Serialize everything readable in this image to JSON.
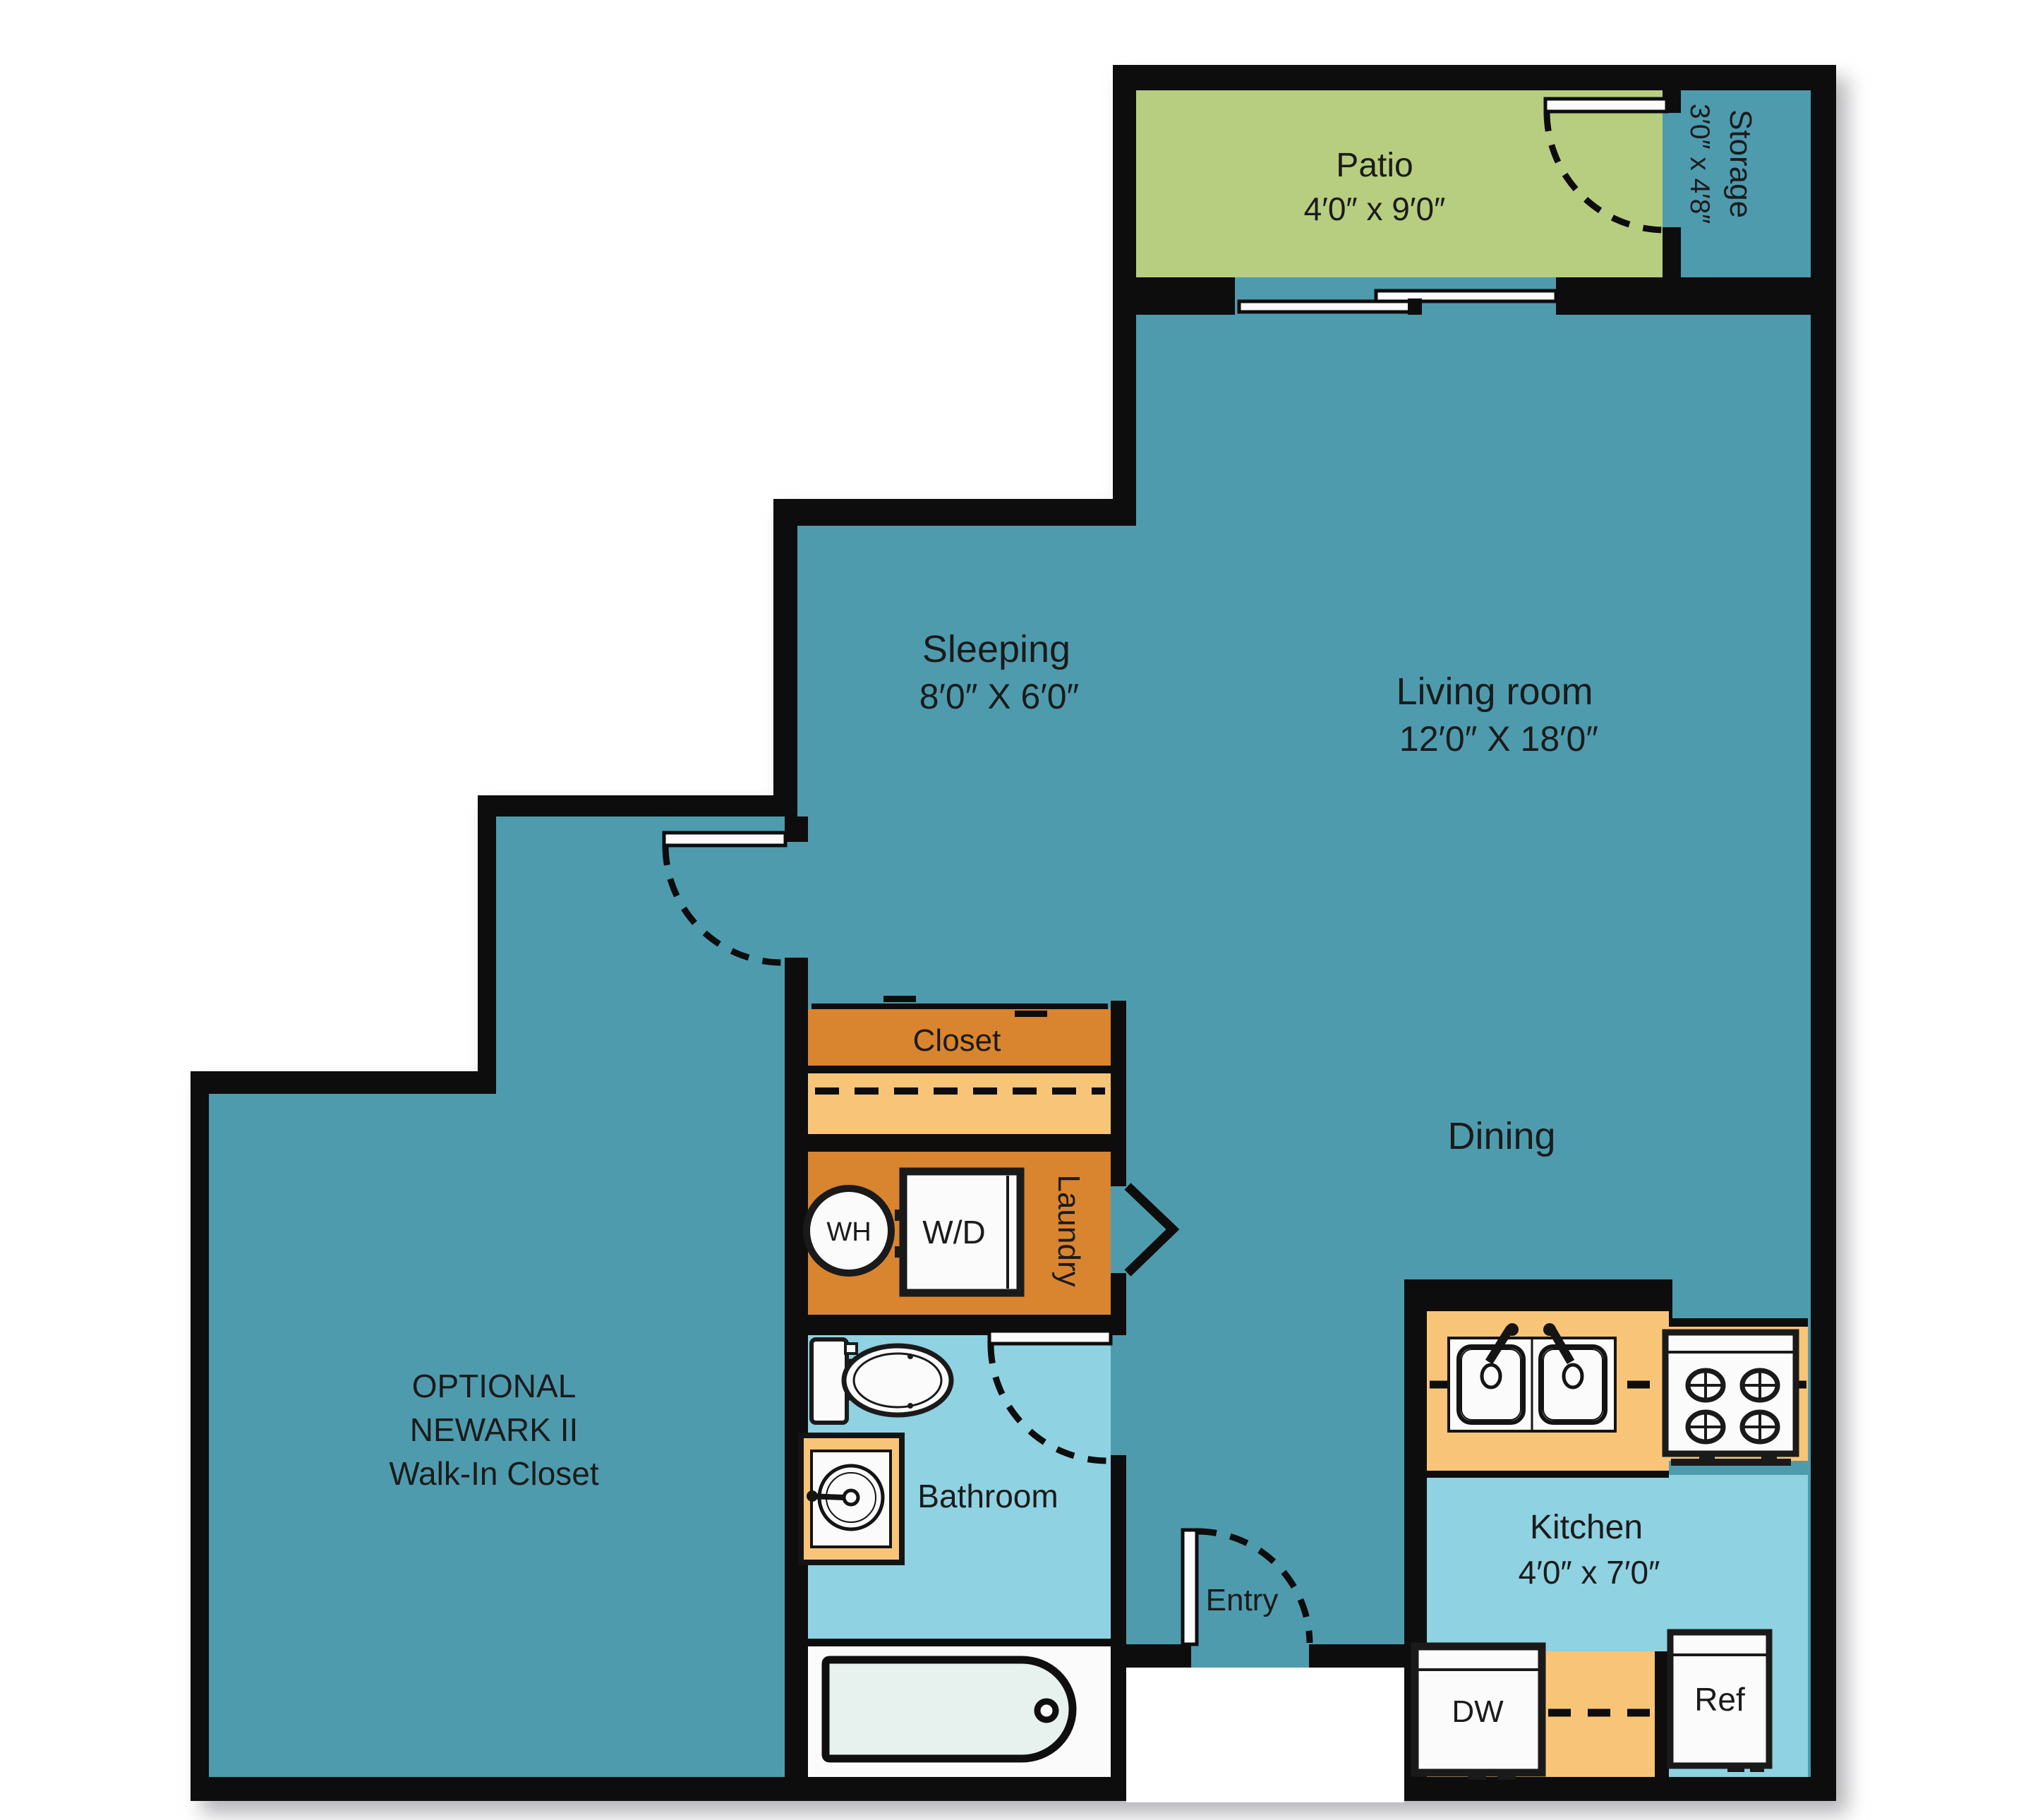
{
  "title": "Apartment floor plan",
  "colors": {
    "wall": "#0d0d0d",
    "main_floor_teal": "#4f9bae",
    "wet_floor_lightblue": "#8fd2e2",
    "patio_green": "#b7ce80",
    "cabinet_dark_orange": "#d9842f",
    "counter_light_orange": "#f8c578",
    "fixture_white": "#fbfbfb",
    "tub_fill": "#e7f2ee",
    "text": "#1b1b1b"
  },
  "rooms": {
    "patio": {
      "label": "Patio",
      "dims": "4′0″ x 9′0″"
    },
    "storage": {
      "label": "Storage",
      "dims": "3′0″ x 4′8″"
    },
    "sleeping": {
      "label": "Sleeping",
      "dims": "8′0″ X 6′0″"
    },
    "living": {
      "label": "Living room",
      "dims": "12′0″ X 18′0″"
    },
    "dining": {
      "label": "Dining"
    },
    "closet": {
      "label": "Closet"
    },
    "laundry": {
      "label": "Laundry"
    },
    "bathroom": {
      "label": "Bathroom"
    },
    "entry": {
      "label": "Entry"
    },
    "kitchen": {
      "label": "Kitchen",
      "dims": "4′0″ x 7′0″"
    },
    "walkin": {
      "line1": "OPTIONAL",
      "line2": "NEWARK II",
      "line3": "Walk-In Closet"
    }
  },
  "fixtures": {
    "water_heater": "WH",
    "washer_dryer": "W/D",
    "dishwasher": "DW",
    "refrigerator": "Ref"
  }
}
